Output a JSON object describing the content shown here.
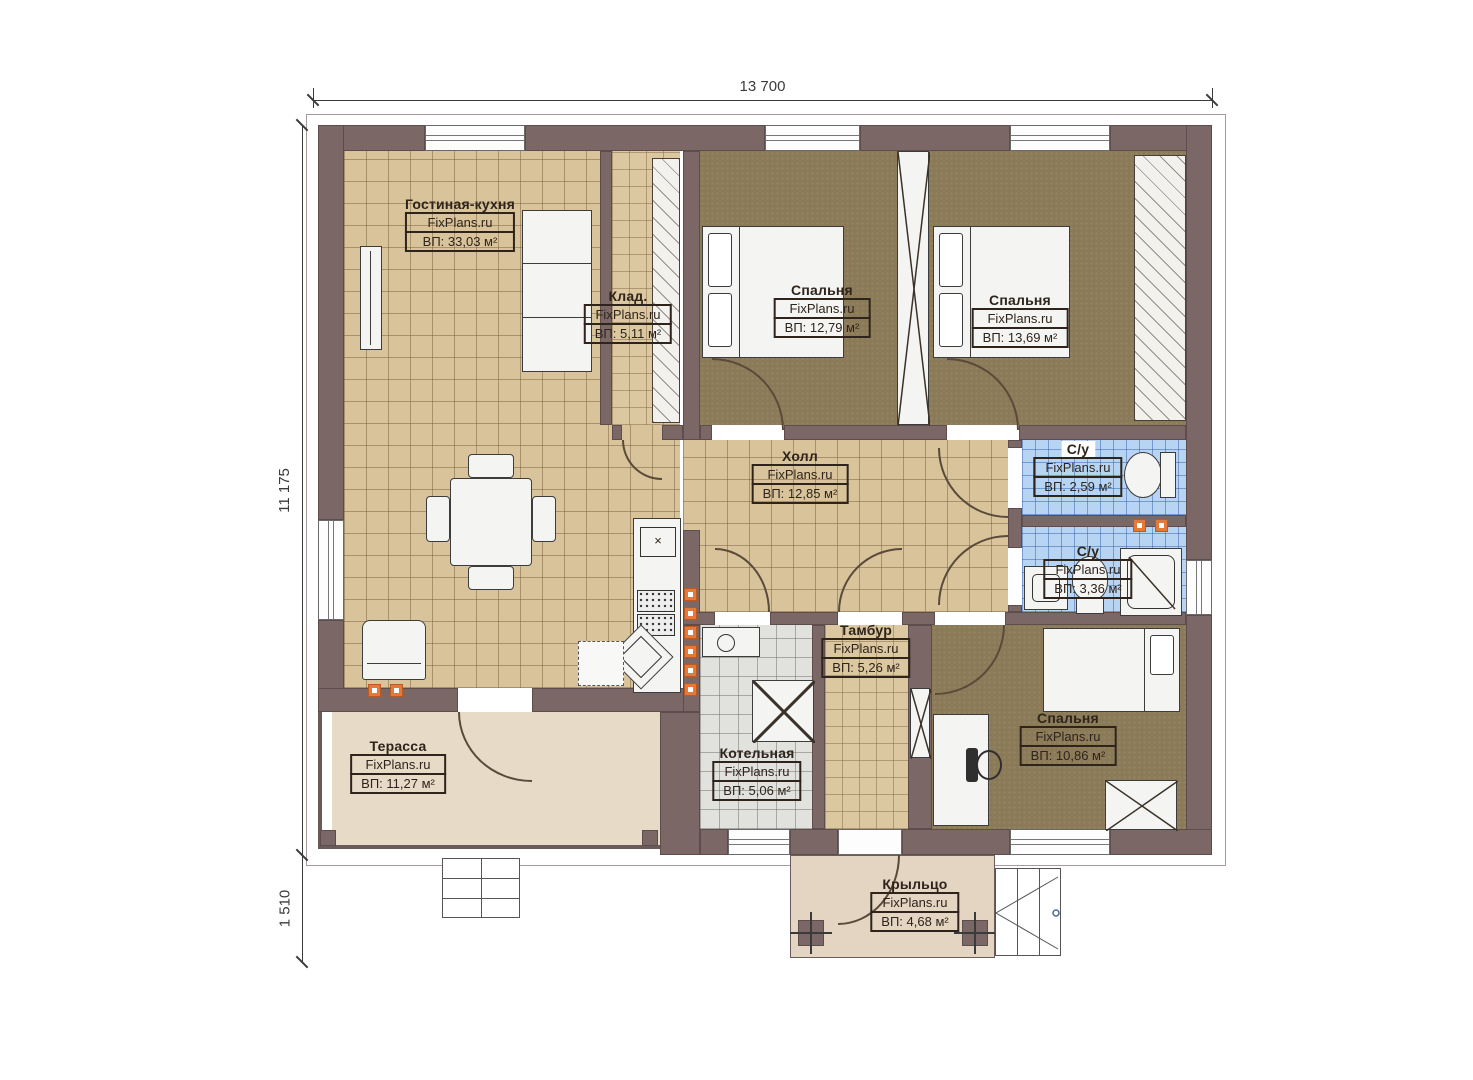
{
  "watermark": "FixPlans.ru",
  "dimensions": {
    "top_width": "13 700",
    "left_height": "11 175",
    "left_porch_height": "1 510"
  },
  "rooms": [
    {
      "name": "Гостиная-кухня",
      "watermark": "FixPlans.ru",
      "area": "ВП: 33,03 м²"
    },
    {
      "name": "Клад.",
      "watermark": "FixPlans.ru",
      "area": "ВП: 5,11 м²"
    },
    {
      "name": "Спальня",
      "watermark": "FixPlans.ru",
      "area": "ВП: 12,79 м²"
    },
    {
      "name": "Спальня",
      "watermark": "FixPlans.ru",
      "area": "ВП: 13,69 м²"
    },
    {
      "name": "Холл",
      "watermark": "FixPlans.ru",
      "area": "ВП: 12,85 м²"
    },
    {
      "name": "С/у",
      "watermark": "FixPlans.ru",
      "area": "ВП: 2,59 м²"
    },
    {
      "name": "С/у",
      "watermark": "FixPlans.ru",
      "area": "ВП: 3,36 м²"
    },
    {
      "name": "Тамбур",
      "watermark": "FixPlans.ru",
      "area": "ВП: 5,26 м²"
    },
    {
      "name": "Котельная",
      "watermark": "FixPlans.ru",
      "area": "ВП: 5,06 м²"
    },
    {
      "name": "Спальня",
      "watermark": "FixPlans.ru",
      "area": "ВП: 10,86 м²"
    },
    {
      "name": "Терасса",
      "watermark": "FixPlans.ru",
      "area": "ВП: 11,27 м²"
    },
    {
      "name": "Крыльцо",
      "watermark": "FixPlans.ru",
      "area": "ВП: 4,68 м²"
    }
  ],
  "colors": {
    "wall": "#7c6767",
    "floor_tile": "#d8c39a",
    "bedroom_carpet": "#8b7a57",
    "bath_tile": "#b7d5f3",
    "boiler_tile": "#e1e1dd",
    "terrace": "#e7dbc7",
    "porch": "#e3d5c1",
    "radiator": "#e4793c"
  }
}
